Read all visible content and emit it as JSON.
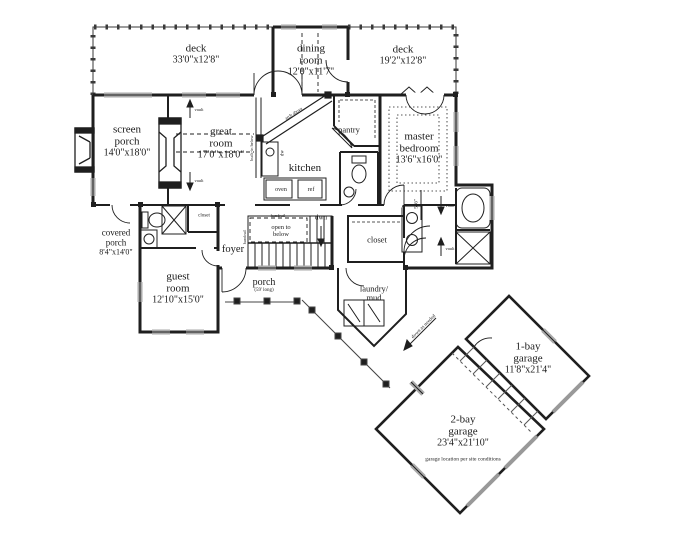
{
  "canvas": {
    "width": 684,
    "height": 550,
    "background": "#ffffff",
    "ink": "#1f1f1f",
    "rail": "#3a3a3a",
    "door_gray": "#999999"
  },
  "rooms": [
    {
      "name": "deck",
      "dims": "33'0\"x12'8\""
    },
    {
      "name": "dining room",
      "dims": "12'0\"x11'7\""
    },
    {
      "name": "deck",
      "dims": "19'2\"x12'8\""
    },
    {
      "name": "screen porch",
      "dims": "14'0\"x18'0\""
    },
    {
      "name": "great room",
      "dims": "17'0\"x18'0\""
    },
    {
      "name": "kitchen",
      "dims": ""
    },
    {
      "name": "pantry",
      "dims": ""
    },
    {
      "name": "master bedroom",
      "dims": "13'6\"x16'0\""
    },
    {
      "name": "covered porch",
      "dims": "8'4\"x14'0\""
    },
    {
      "name": "foyer",
      "dims": ""
    },
    {
      "name": "guest room",
      "dims": "12'10\"x15'0\""
    },
    {
      "name": "porch",
      "dims": "(59' long)"
    },
    {
      "name": "closet",
      "dims": ""
    },
    {
      "name": "laundry/ mud",
      "dims": ""
    },
    {
      "name": "1-bay garage",
      "dims": "11'8\"x21'4\""
    },
    {
      "name": "2-bay garage",
      "dims": "23'4\"x21'10\""
    }
  ],
  "annotations": {
    "open_to_below": "open to below",
    "down": "dwn",
    "handrail": "handrail",
    "oven": "oven",
    "ref": "ref",
    "dw": "dw",
    "vault": "vault",
    "built_in": "built-in below",
    "arch": "arch above",
    "closet_small": "closet",
    "garage_note": "garage location per site conditions",
    "breezeway_note": "down as needed",
    "dim_5_6": "5'-6\""
  }
}
